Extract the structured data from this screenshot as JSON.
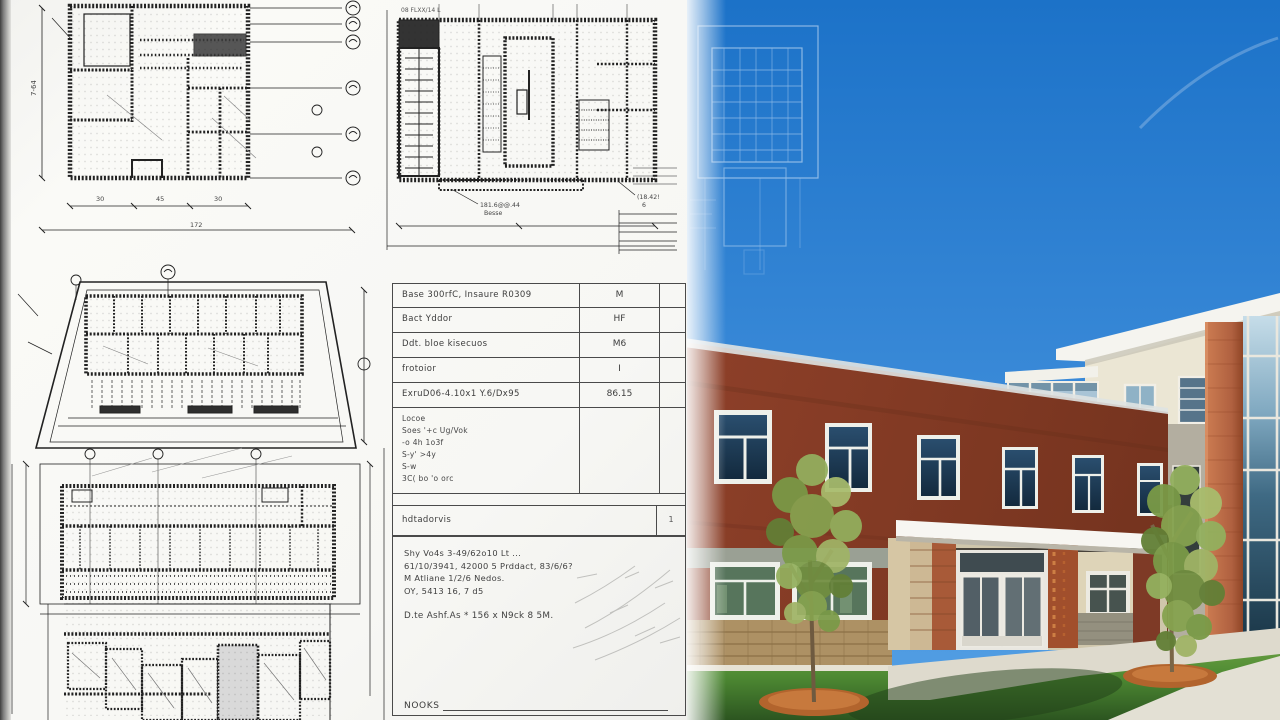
{
  "paper": {
    "plan1": {
      "dim_left": "7-64",
      "dim_b1": "30",
      "dim_b2": "45",
      "dim_b3": "30",
      "dim_total": "172"
    },
    "plan2": {
      "title": "08 FLXX/14 L",
      "caption_a1": "181.6@@.44",
      "caption_a2": "Besse",
      "caption_b1": "(18.42!",
      "caption_b2": "6"
    },
    "schedule": {
      "rows": [
        {
          "label": "Base 300rfC, Insaure R0309",
          "value": "M"
        },
        {
          "label": "Bact Yddor",
          "value": "HF"
        },
        {
          "label": "Ddt. bloe kisecuos",
          "value": "M6"
        },
        {
          "label": "frotoior",
          "value": "I"
        },
        {
          "label": "ExruD06-4.10x1 Y.6/Dx95",
          "value": "86.15"
        }
      ],
      "notes_lines": [
        "Locoe",
        "Soes '+c Ug/Vok",
        "-o 4h     1o3f",
        "S-y'   >4y",
        "S-w",
        "3C( bo 'o orc"
      ],
      "subrow": {
        "label": "hdtadorvis",
        "value": "1"
      },
      "block_lines": [
        "Shy Vo4s 3-49/62o10 Lt ...",
        "61/10/3941, 42000 5 Prddact, 83/6/6?",
        "M Atliane 1/2/6 Nedos.",
        "OY, 5413 16, 7 d5"
      ],
      "block_highlight": "D.te Ashf.As   *   156 x N9ck 8 5M.",
      "footer_label": "NOOKS"
    }
  },
  "photo": {
    "colors": {
      "sky_top": "#1c72c8",
      "sky_bottom": "#4f9ce2",
      "brick_facade": "#823c26",
      "brick_pillar": "#bc6c46",
      "cream_wall": "#ebe6d4",
      "fascia_white": "#f5f4ef",
      "window_glass": "#1e3a54",
      "curtain_glass": "#3f6a84",
      "lawn_green": "#4e8a33",
      "mulch": "#b2642d",
      "concrete_walk": "#dedacd",
      "canopy_white": "#f7f6f2",
      "stone_wainscot": "#b79b6d"
    }
  }
}
